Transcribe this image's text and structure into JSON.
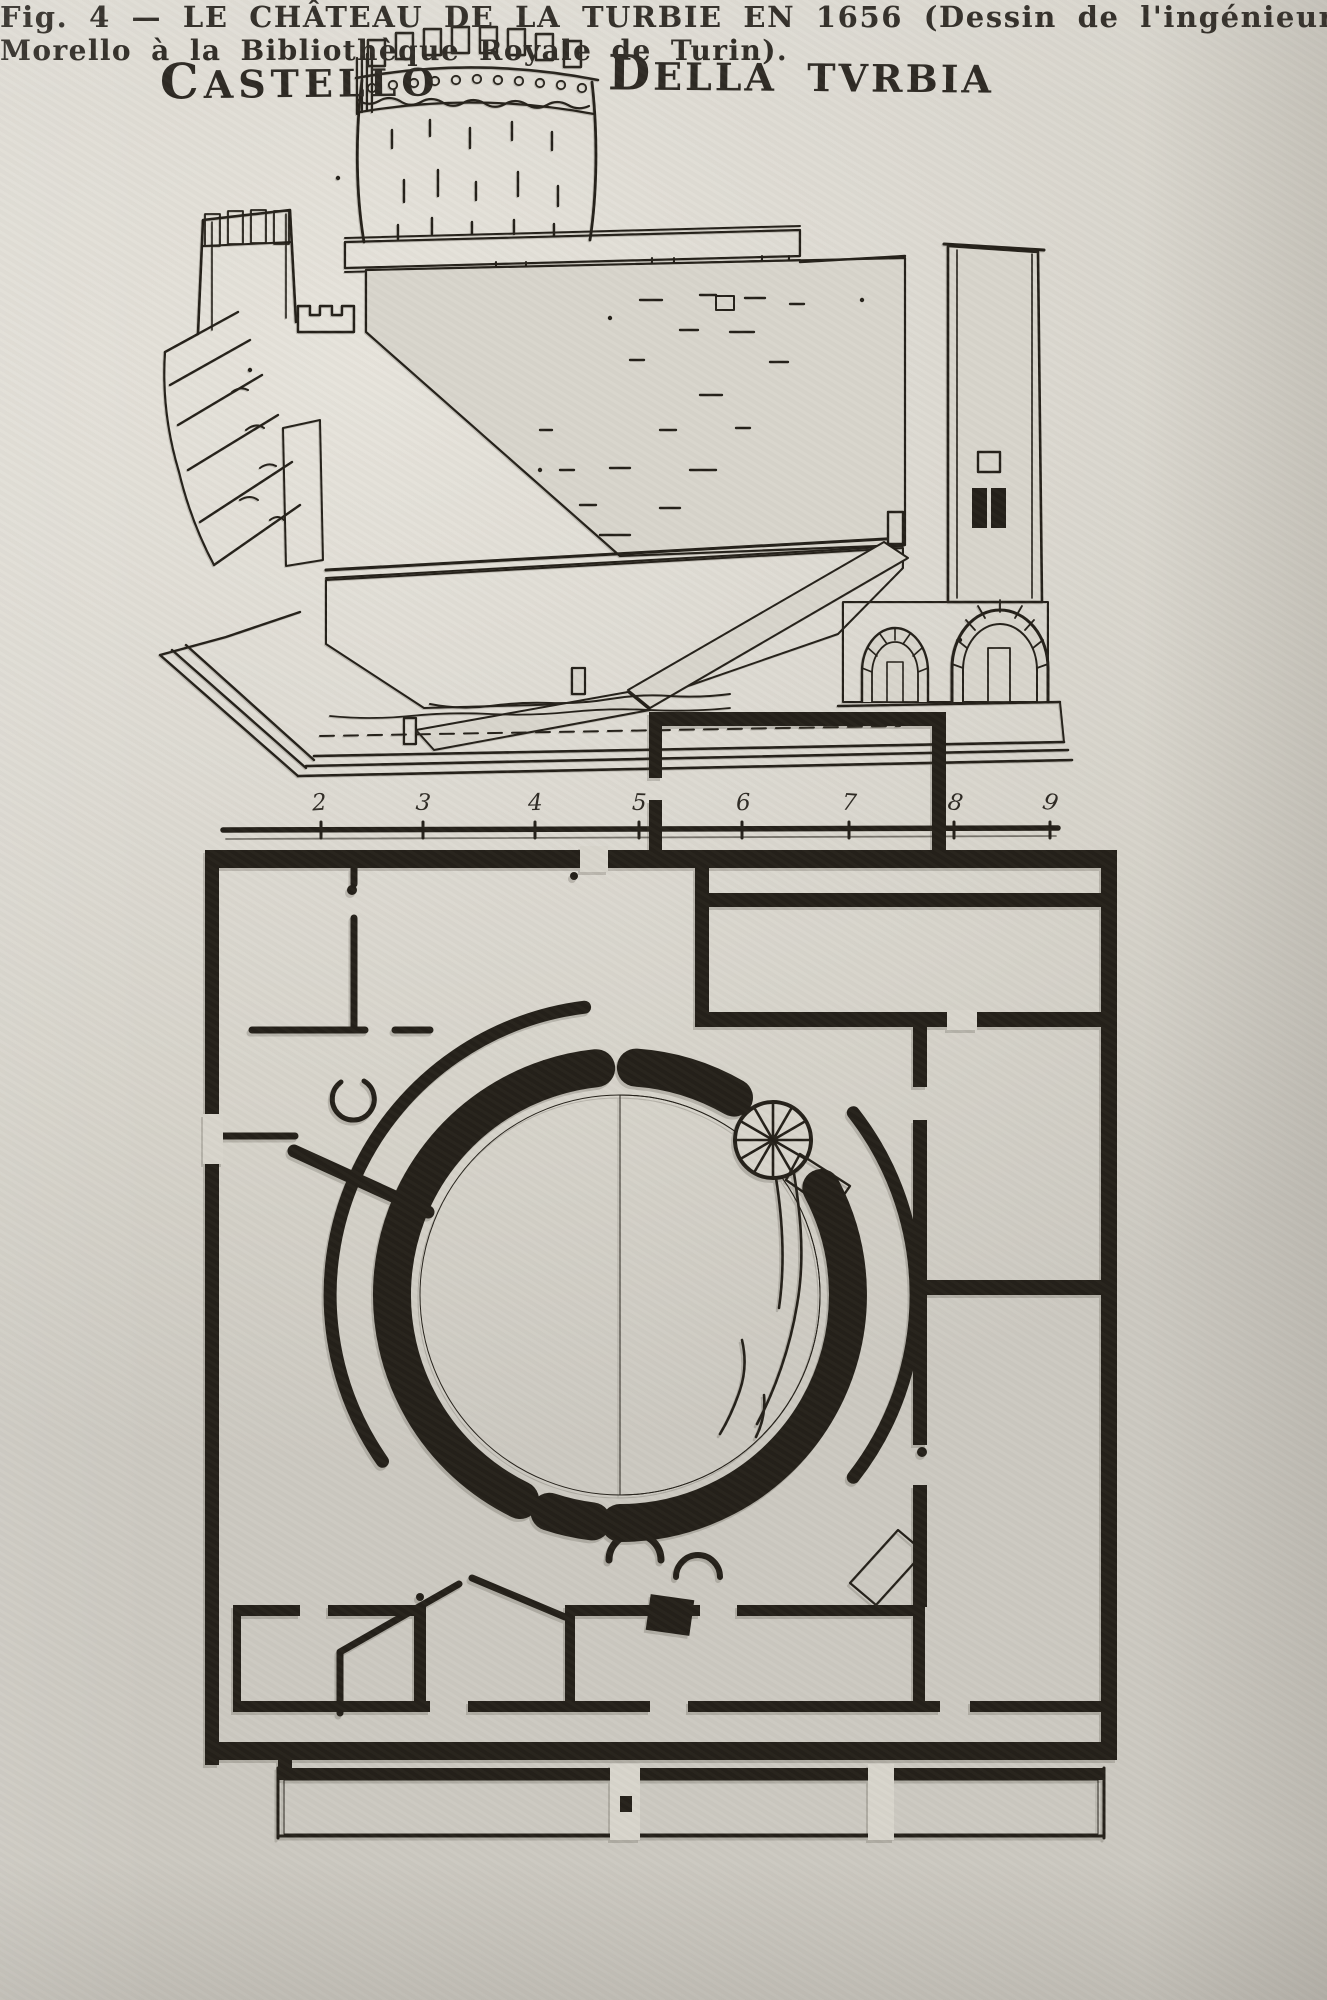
{
  "page": {
    "colors": {
      "paper": "#d8d5cc",
      "ink": "#242019"
    }
  },
  "figure": {
    "heading": {
      "left": "CASTELLO",
      "right": "DELLA TVRBIA"
    },
    "scale_bar": {
      "ticks": [
        "2",
        "3",
        "4",
        "5",
        "6",
        "7",
        "8",
        "9"
      ]
    },
    "caption": {
      "line1": "Fig. 4 — LE CHÂTEAU DE LA TURBIE EN 1656 (Dessin de l'ingénieur C.",
      "line2": "Morello à la Bibliothèque Royale de Turin)."
    }
  }
}
